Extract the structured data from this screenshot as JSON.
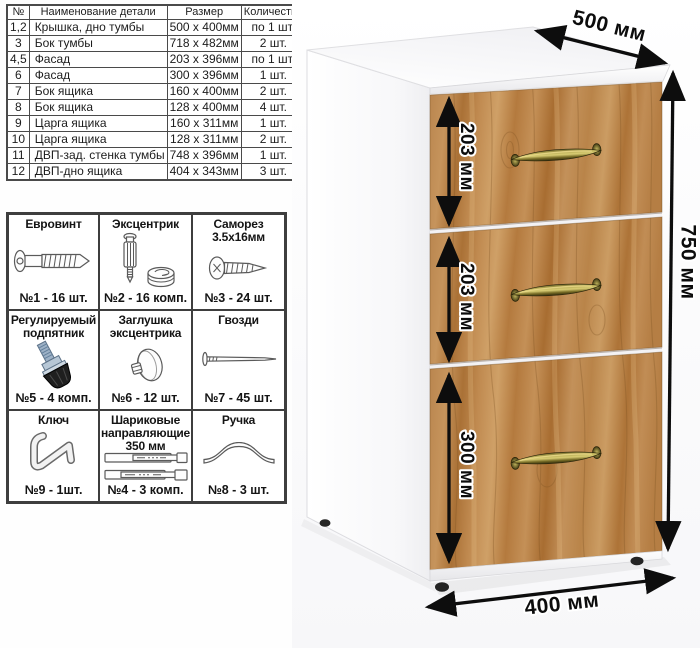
{
  "parts_table": {
    "headers": [
      "№",
      "Наименование детали",
      "Размер",
      "Количество"
    ],
    "rows": [
      {
        "num": "1,2",
        "name": "Крышка, дно тумбы",
        "size": "500 x 400мм",
        "qty": "по 1 шт."
      },
      {
        "num": "3",
        "name": "Бок тумбы",
        "size": "718 x 482мм",
        "qty": "2 шт."
      },
      {
        "num": "4,5",
        "name": "Фасад",
        "size": "203 x 396мм",
        "qty": "по 1 шт."
      },
      {
        "num": "6",
        "name": "Фасад",
        "size": "300 x 396мм",
        "qty": "1 шт."
      },
      {
        "num": "7",
        "name": "Бок ящика",
        "size": "160 x 400мм",
        "qty": "2 шт."
      },
      {
        "num": "8",
        "name": "Бок ящика",
        "size": "128 x 400мм",
        "qty": "4 шт."
      },
      {
        "num": "9",
        "name": "Царга ящика",
        "size": "160 x 311мм",
        "qty": "1 шт."
      },
      {
        "num": "10",
        "name": "Царга ящика",
        "size": "128 x 311мм",
        "qty": "2 шт."
      },
      {
        "num": "11",
        "name": "ДВП-зад. стенка тумбы",
        "size": "748 x 396мм",
        "qty": "1 шт."
      },
      {
        "num": "12",
        "name": "ДВП-дно ящика",
        "size": "404 x 343мм",
        "qty": "3 шт."
      }
    ]
  },
  "hardware": {
    "items": [
      {
        "title": "Евровинт",
        "count": "№1 - 16 шт.",
        "icon": "euro-screw-icon"
      },
      {
        "title": "Эксцентрик",
        "count": "№2 - 16 комп.",
        "icon": "cam-bolt-icon"
      },
      {
        "title": "Саморез 3.5х16мм",
        "count": "№3 - 24 шт.",
        "icon": "self-tapping-screw-icon"
      },
      {
        "title": "Регулируемый подпятник",
        "count": "№5 - 4 комп.",
        "icon": "adjustable-foot-icon"
      },
      {
        "title": "Заглушка эксцентрика",
        "count": "№6 - 12 шт.",
        "icon": "cam-cover-icon"
      },
      {
        "title": "Гвозди",
        "count": "№7 - 45 шт.",
        "icon": "nail-icon"
      },
      {
        "title": "Ключ",
        "count": "№9 - 1шт.",
        "icon": "hex-key-icon"
      },
      {
        "title": "Шариковые направляющие 350 мм",
        "count": "№4 - 3 комп.",
        "icon": "ball-slides-icon"
      },
      {
        "title": "Ручка",
        "count": "№8 - 3 шт.",
        "icon": "bow-handle-icon"
      }
    ]
  },
  "cabinet": {
    "dimensions": {
      "depth": "500 мм",
      "height": "750 мм",
      "width": "400 мм",
      "drawer1": "203 мм",
      "drawer2": "203 мм",
      "drawer3": "300 мм"
    },
    "colors": {
      "wood": "#b8834b",
      "handle_brass": "#8a7f33",
      "carcass": "#ffffff",
      "arrow": "#0d0d0d"
    }
  }
}
